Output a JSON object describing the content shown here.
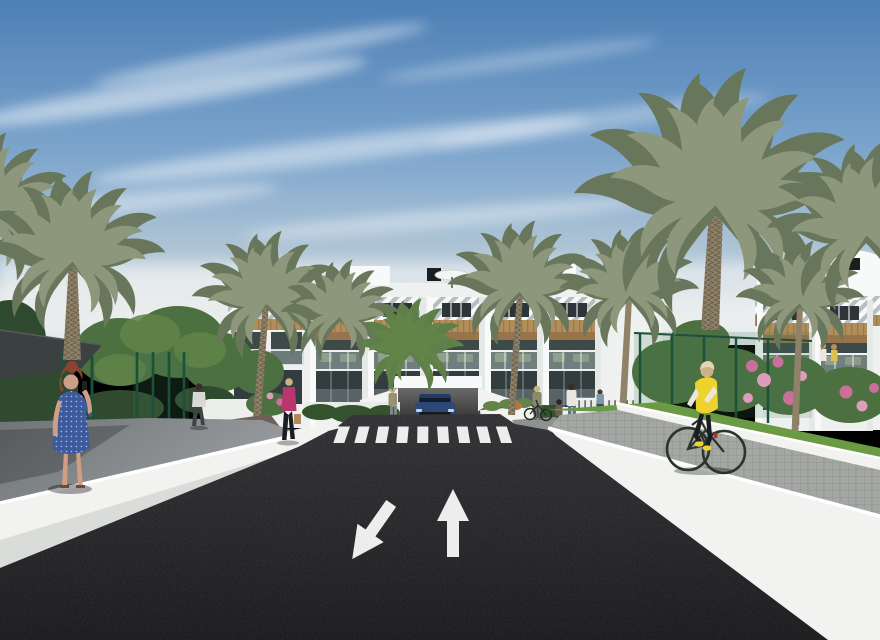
{
  "scene": {
    "type": "architectural-render",
    "description": "3D render of a modern white apartment complex with wood-slat accents, palm trees, a dark asphalt access road with painted lane arrows and a zebra crosswalk, an underground garage entrance with a blue car, pedestrians, and a cyclist in a yellow hi-vis vest on a side path",
    "objects": [
      "sky-with-cirrus-clouds",
      "apartment-building",
      "rooftop-parasols",
      "rooftop-vents",
      "palm-trees",
      "green-mesh-fence",
      "flowering-bushes",
      "asphalt-road",
      "zebra-crosswalk",
      "lane-arrow-up",
      "lane-arrow-down-left",
      "underground-garage",
      "blue-car",
      "woman-on-phone",
      "walking-man",
      "woman-with-shopping-bag",
      "pedestrian-group",
      "cyclist"
    ]
  },
  "colors": {
    "sky_top": "#4d7fb5",
    "sky_mid": "#7ea6cd",
    "sky_low": "#b9cbd7",
    "sky_horizon": "#e3e7e8",
    "cloud_white": "#ffffff",
    "building_white": "#eff1f0",
    "building_bright": "#f8faf9",
    "building_shadow": "#d9dedf",
    "pergola_stripe": "#b7bec2",
    "window_dark": "#2d3538",
    "interior_dark": "#3d4a48",
    "glazing_dark": "#333d3f",
    "wood": "#b28e5a",
    "wood_dark": "#97744a",
    "glass_rail": "#b7c6cb",
    "furniture_olive": "#74855f",
    "hedge_dark": "#35522f",
    "tree_green": "#4d7040",
    "tree_light": "#628449",
    "lawn_green": "#6a9a44",
    "palm_dark": "#68775b",
    "palm_light": "#8d977b",
    "palm_bright": "#5f7f4a",
    "trunk": "#8f8268",
    "fence_green": "#1d5038",
    "mesh_green": "#3f7a52",
    "flower_pink": "#c9709a",
    "flower_light": "#dd9cba",
    "asphalt": "#232327",
    "asphalt_top": "#2e2e32",
    "marking_white": "#ededeb",
    "wall_white": "#f2f3f1",
    "wall_shade": "#dcdfde",
    "pavement_gray": "#7e8285",
    "paver_gray": "#a4a7a4",
    "path_brown": "#6e6058",
    "canopy_dark": "#3b4041",
    "car_blue": "#2c4878",
    "car_glass": "#131c28",
    "skin": "#cf9f85",
    "dress_blue": "#3d5a9c",
    "hair_auburn": "#8a4330",
    "vest_yellow": "#eed32e",
    "shirt_white": "#e9e7e0",
    "pants_dark": "#1b1d20",
    "jacket_magenta": "#b8356e",
    "hair_blonde": "#cdb287",
    "denim": "#5e7391",
    "bike_dark": "#2a352b",
    "taillight_red": "#c22a2a"
  }
}
